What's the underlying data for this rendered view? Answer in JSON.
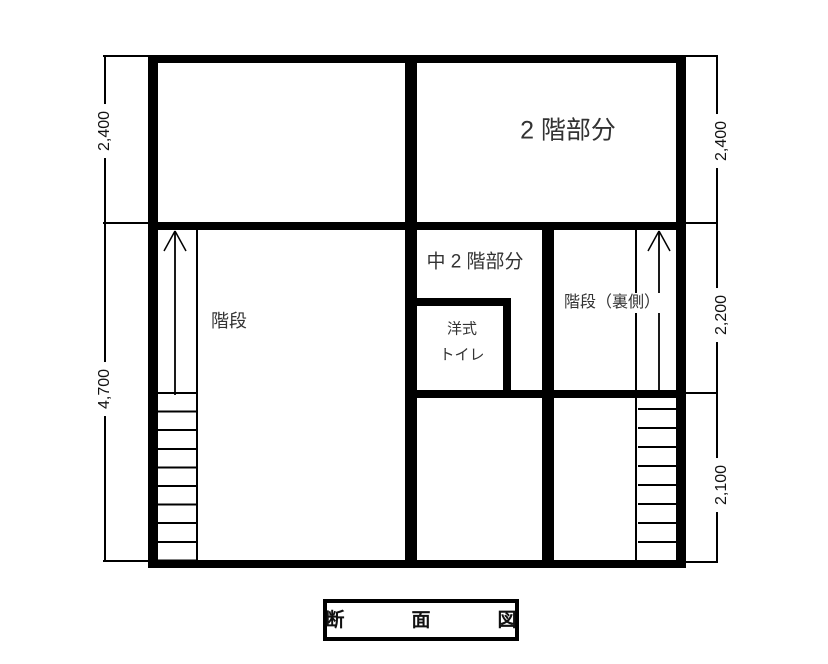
{
  "drawing": {
    "title": "断　面　図",
    "labels": {
      "second_floor": "2 階部分",
      "mezzanine": "中 2 階部分",
      "stairs": "階段",
      "toilet": [
        "洋式",
        "トイレ"
      ],
      "stairs_back": "階段（裏側）"
    },
    "dimensions": {
      "left": [
        {
          "value": "2,400"
        },
        {
          "value": "4,700"
        }
      ],
      "right": [
        {
          "value": "2,400"
        },
        {
          "value": "2,200"
        },
        {
          "value": "2,100"
        }
      ]
    },
    "colors": {
      "line": "#000000",
      "text": "#333333",
      "background": "#ffffff"
    }
  }
}
